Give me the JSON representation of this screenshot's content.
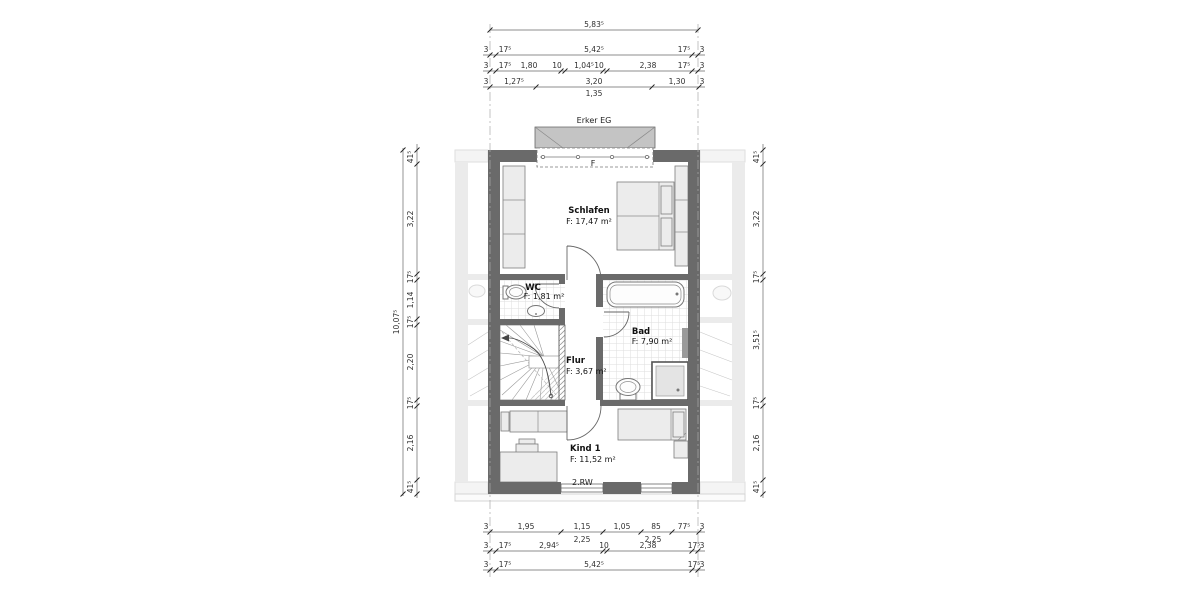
{
  "colors": {
    "wall": "#6a6a6a",
    "fixture": "#ececec",
    "erker": "#c4c4c4",
    "neighbor": "#dcdcdc",
    "dim_text": "#2e2e2e"
  },
  "labels": {
    "erker": "Erker EG",
    "window": "F",
    "escape_route": "2.RW"
  },
  "rooms": {
    "schlafen": {
      "name": "Schlafen",
      "area": "F: 17,47 m²"
    },
    "wc": {
      "name": "WC",
      "area": "F: 1,81 m²"
    },
    "bad": {
      "name": "Bad",
      "area": "F: 7,90 m²"
    },
    "flur": {
      "name": "Flur",
      "area": "F: 3,67 m²"
    },
    "kind1": {
      "name": "Kind 1",
      "area": "F: 11,52 m²"
    }
  },
  "dims": {
    "top": {
      "total": "5,83⁵",
      "row2": [
        "3",
        "17⁵",
        "5,42⁵",
        "17⁵",
        "3"
      ],
      "row3": [
        "3",
        "17⁵",
        "1,80",
        "10",
        "1,04⁵",
        "10",
        "2,38",
        "17⁵",
        "3"
      ],
      "row4": [
        "3",
        "1,27⁵",
        "3,20",
        "1,30",
        "3"
      ],
      "row4_sub": "1,35"
    },
    "bottom": {
      "row1": [
        "3",
        "1,95",
        "1,15",
        "1,05",
        "85",
        "77⁵",
        "3"
      ],
      "row1_sub": [
        "2,25",
        "2,25"
      ],
      "row2": [
        "3",
        "17⁵",
        "2,94⁵",
        "10",
        "2,38",
        "17⁵",
        "3"
      ],
      "row3": [
        "3",
        "17⁵",
        "5,42⁵",
        "17⁵",
        "3"
      ]
    },
    "left": {
      "total": "10,07⁵",
      "chain": [
        "41⁵",
        "3,22",
        "17⁵",
        "1,14",
        "17⁵",
        "2,20",
        "17⁵",
        "2,16",
        "41⁵"
      ]
    },
    "right": {
      "chain": [
        "41⁵",
        "3,22",
        "17⁵",
        "3,51⁵",
        "17⁵",
        "2,16",
        "41⁵"
      ]
    }
  }
}
